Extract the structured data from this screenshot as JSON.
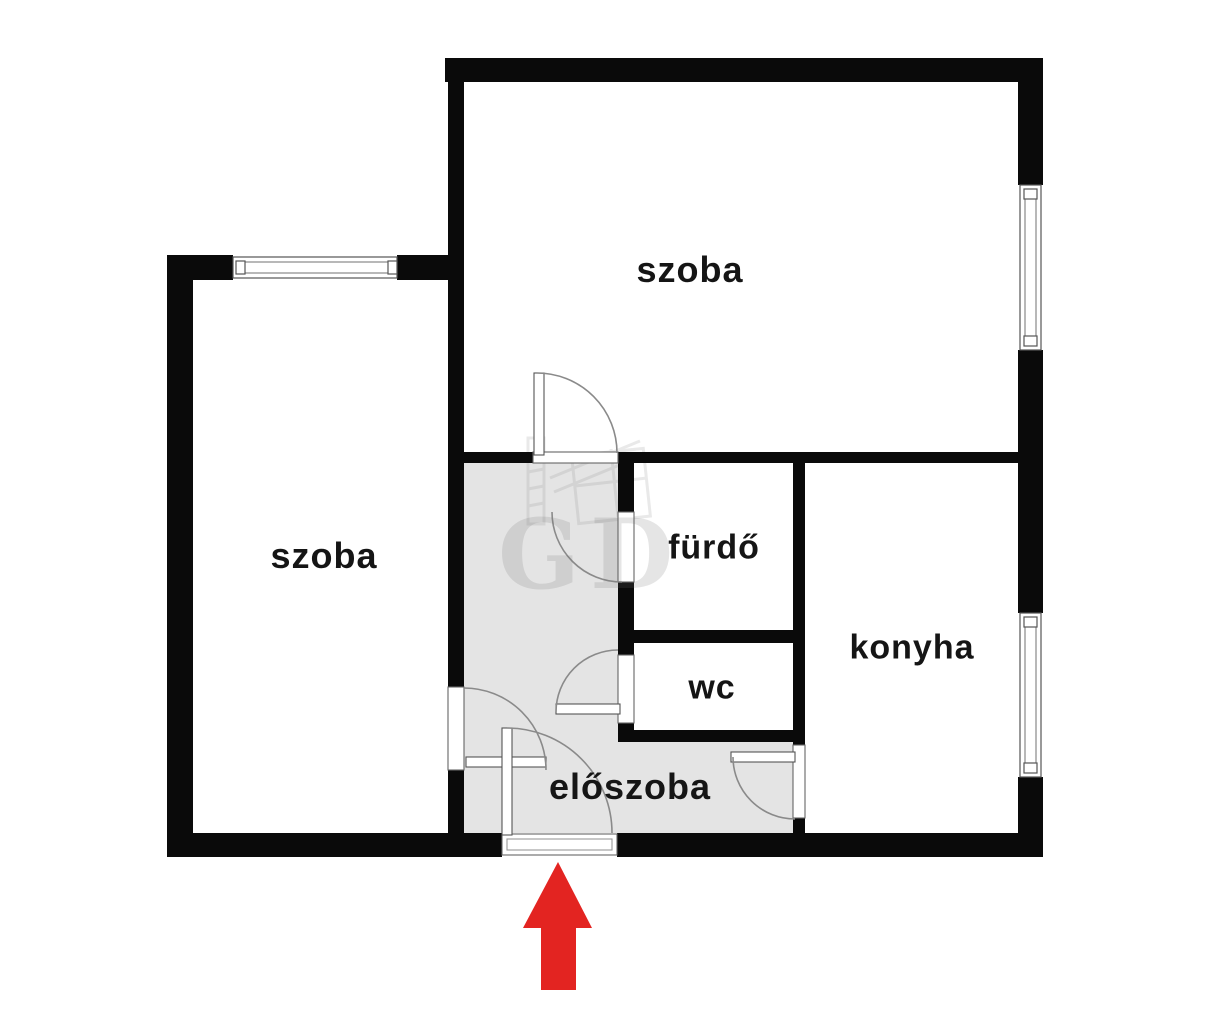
{
  "plan": {
    "rooms": [
      {
        "id": "room-top",
        "label": "szoba"
      },
      {
        "id": "room-left",
        "label": "szoba"
      },
      {
        "id": "bathroom",
        "label": "fürdő"
      },
      {
        "id": "wc",
        "label": "wc"
      },
      {
        "id": "kitchen",
        "label": "konyha"
      },
      {
        "id": "hallway",
        "label": "előszoba"
      }
    ],
    "watermark": {
      "text": "GD"
    },
    "annotations": [
      {
        "id": "entrance-arrow",
        "icon": "up-arrow-icon",
        "meaning": "entrance direction marker"
      }
    ],
    "colors": {
      "wall": "#0a0a0a",
      "hallway_fill": "#e4e4e4",
      "arrow": "#e32421",
      "background": "#ffffff",
      "door_line": "#8a8a8a"
    }
  }
}
